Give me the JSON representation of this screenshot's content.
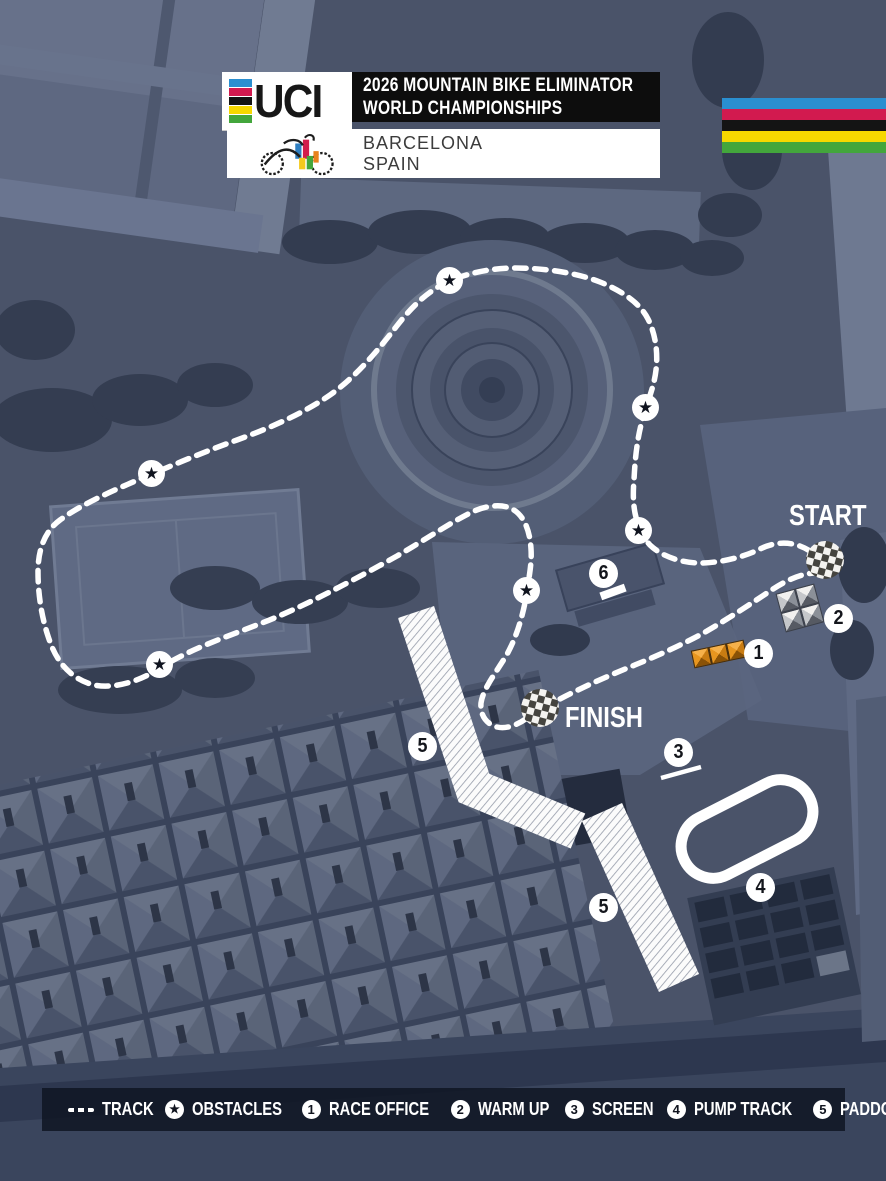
{
  "header": {
    "uci_wordmark": "UCI",
    "title_line1": "2026 MOUNTAIN BIKE ELIMINATOR",
    "title_line2": "WORLD CHAMPIONSHIPS",
    "city": "BARCELONA",
    "country": "SPAIN"
  },
  "course": {
    "start_label": "START",
    "finish_label": "FINISH",
    "badges": [
      {
        "num": "1"
      },
      {
        "num": "2"
      },
      {
        "num": "3"
      },
      {
        "num": "4"
      },
      {
        "num": "5"
      },
      {
        "num": "5"
      },
      {
        "num": "6"
      }
    ]
  },
  "legend": {
    "items": [
      {
        "icon": "dashes",
        "label": "TRACK"
      },
      {
        "icon": "star",
        "label": "OBSTACLES"
      },
      {
        "icon": "1",
        "label": "RACE OFFICE"
      },
      {
        "icon": "2",
        "label": "WARM UP"
      },
      {
        "icon": "3",
        "label": "SCREEN"
      },
      {
        "icon": "4",
        "label": "PUMP TRACK"
      },
      {
        "icon": "5",
        "label": "PADDOCK"
      },
      {
        "icon": "6",
        "label": "PODIUM"
      }
    ]
  },
  "icons": {
    "star": "★"
  },
  "colors": {
    "rainbow_blue": "#2a8fd0",
    "rainbow_red": "#d21a4f",
    "rainbow_black": "#141414",
    "rainbow_yellow": "#f6d800",
    "rainbow_green": "#43a63c",
    "race_office_orange": "#e8961f",
    "track_white": "#ffffff"
  }
}
